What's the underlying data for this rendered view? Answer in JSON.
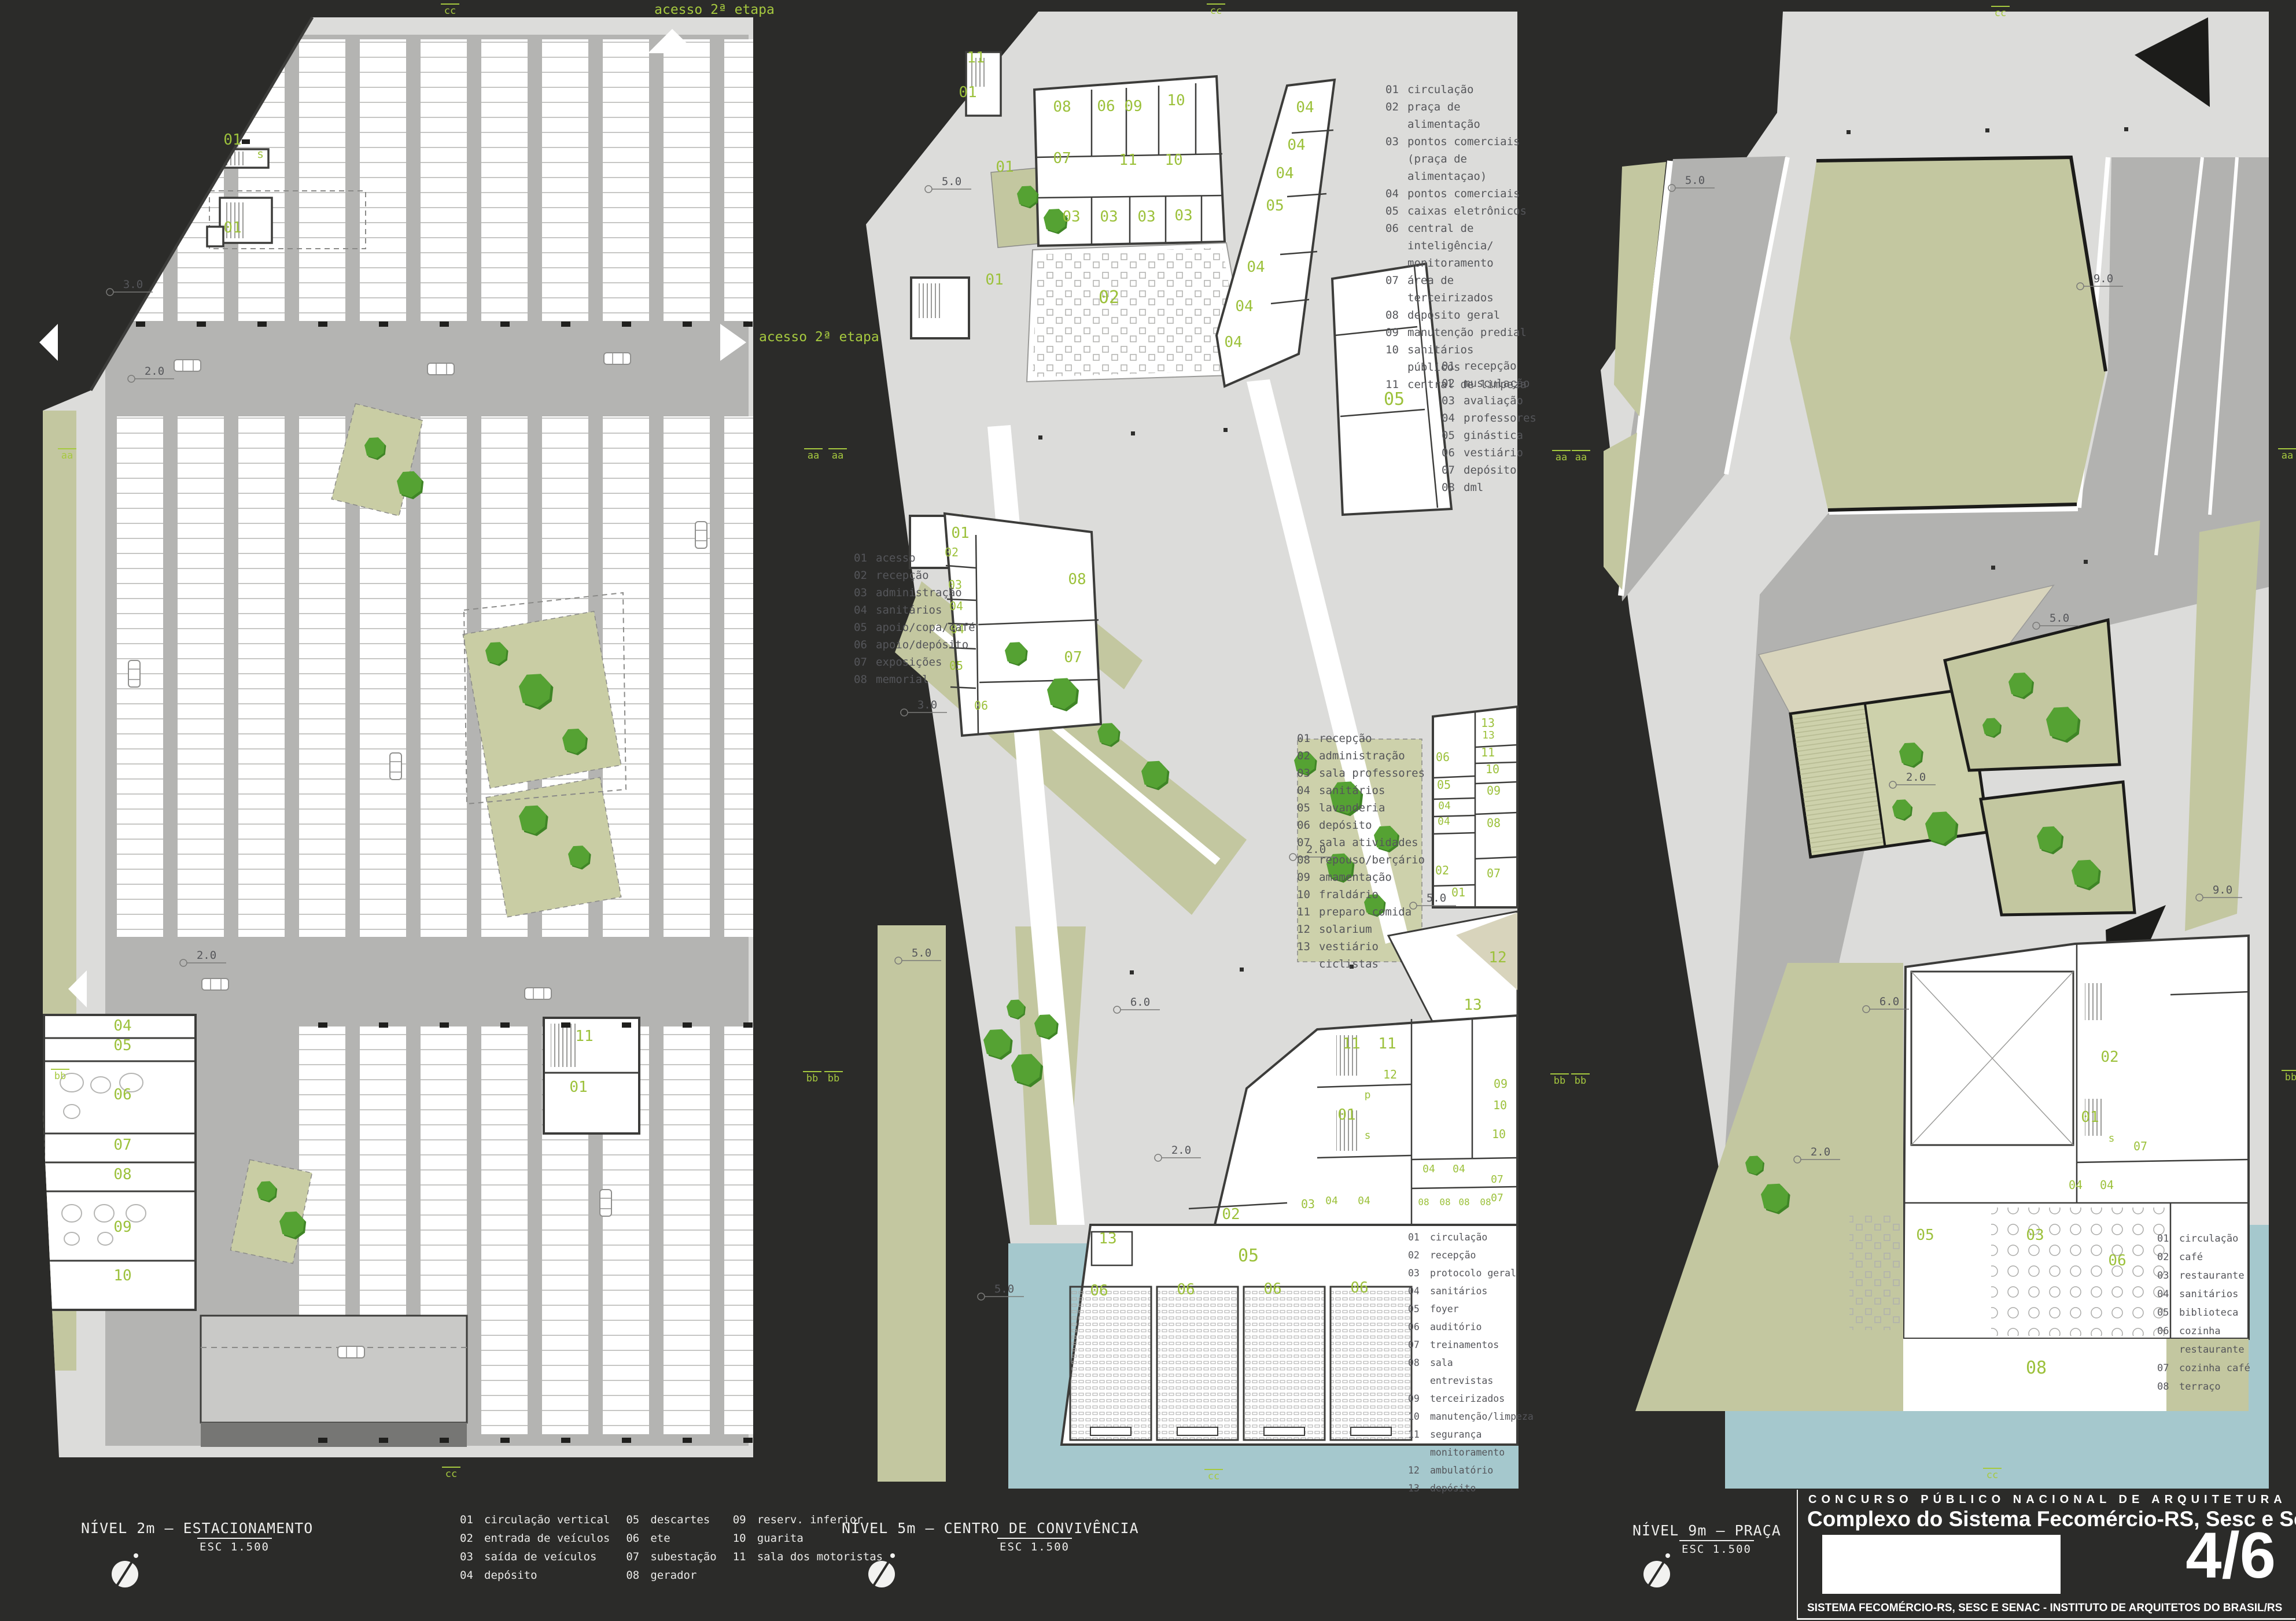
{
  "colors": {
    "background": "#2b2b29",
    "plan": "#dcdcda",
    "road": "#b2b2b0",
    "vegetation": "#c3c7a0",
    "vegetation_light": "#cdd1ab",
    "water": "#a5c8cd",
    "tree": "#55a233",
    "beige": "#d8d4bc",
    "label_green": "#9cc13b",
    "wall": "#3c3c3a"
  },
  "access_labels": {
    "top": "acesso 2ª etapa",
    "right": "acesso 2ª etapa"
  },
  "panels": {
    "parking": {
      "title": "NÍVEL 2m – ESTACIONAMENTO",
      "scale_label": "ESC 1.500",
      "legend_columns": [
        [
          {
            "n": "01",
            "l": "circulação vertical"
          },
          {
            "n": "02",
            "l": "entrada de veículos"
          },
          {
            "n": "03",
            "l": "saída de veículos"
          },
          {
            "n": "04",
            "l": "depósito"
          }
        ],
        [
          {
            "n": "05",
            "l": "descartes"
          },
          {
            "n": "06",
            "l": "ete"
          },
          {
            "n": "07",
            "l": "subestação"
          },
          {
            "n": "08",
            "l": "gerador"
          }
        ],
        [
          {
            "n": "09",
            "l": "reserv. inferior"
          },
          {
            "n": "10",
            "l": "guarita"
          },
          {
            "n": "11",
            "l": "sala dos motoristas"
          }
        ]
      ],
      "labels": [
        [
          "01",
          340,
          230
        ],
        [
          "s",
          388,
          253,
          20
        ],
        [
          "01",
          340,
          382
        ],
        [
          "04",
          150,
          1762
        ],
        [
          "05",
          150,
          1796
        ],
        [
          "06",
          150,
          1881
        ],
        [
          "07",
          150,
          1968
        ],
        [
          "08",
          150,
          2019
        ],
        [
          "09",
          150,
          2110
        ],
        [
          "10",
          150,
          2194
        ],
        [
          "11",
          948,
          1780
        ],
        [
          "01",
          938,
          1868
        ]
      ],
      "markers": [
        [
          "3.0",
          128,
          478
        ],
        [
          "2.0",
          165,
          628
        ],
        [
          "2.0",
          255,
          1638
        ]
      ]
    },
    "convivencia": {
      "title": "NÍVEL 5m – CENTRO DE CONVIVÊNCIA",
      "scale_label": "ESC 1.500",
      "legend_food": {
        "items": [
          {
            "n": "01",
            "l": "circulação"
          },
          {
            "n": "02",
            "l": "praça de alimentação"
          },
          {
            "n": "03",
            "l": "pontos comerciais\n(praça de alimentaçao)"
          },
          {
            "n": "04",
            "l": "pontos comerciais"
          },
          {
            "n": "05",
            "l": "caixas eletrônicos"
          },
          {
            "n": "06",
            "l": "central de inteligência/\nmonitoramento"
          },
          {
            "n": "07",
            "l": "área de terceirizados"
          },
          {
            "n": "08",
            "l": "depósito geral"
          },
          {
            "n": "09",
            "l": "manutenção predial"
          },
          {
            "n": "10",
            "l": "sanitários públicos"
          },
          {
            "n": "11",
            "l": "central de limpeza"
          }
        ]
      },
      "legend_gym": {
        "items": [
          {
            "n": "01",
            "l": "recepção"
          },
          {
            "n": "02",
            "l": "musculação"
          },
          {
            "n": "03",
            "l": "avaliação"
          },
          {
            "n": "04",
            "l": "professores"
          },
          {
            "n": "05",
            "l": "ginástica"
          },
          {
            "n": "06",
            "l": "vestiário"
          },
          {
            "n": "07",
            "l": "depósito"
          },
          {
            "n": "08",
            "l": "dml"
          }
        ]
      },
      "legend_memorial": {
        "items": [
          {
            "n": "01",
            "l": "acesso"
          },
          {
            "n": "02",
            "l": "recepção"
          },
          {
            "n": "03",
            "l": "administração"
          },
          {
            "n": "04",
            "l": "sanitários"
          },
          {
            "n": "05",
            "l": "apoio/copa/café"
          },
          {
            "n": "06",
            "l": "apoio/depósito"
          },
          {
            "n": "07",
            "l": "exposições"
          },
          {
            "n": "08",
            "l": "memorial"
          }
        ]
      },
      "legend_creche": {
        "items": [
          {
            "n": "01",
            "l": "recepção"
          },
          {
            "n": "02",
            "l": "administração"
          },
          {
            "n": "03",
            "l": "sala professores"
          },
          {
            "n": "04",
            "l": "sanitários"
          },
          {
            "n": "05",
            "l": "lavanderia"
          },
          {
            "n": "06",
            "l": "depósito"
          },
          {
            "n": "07",
            "l": "sala atividades"
          },
          {
            "n": "08",
            "l": "repouso/berçário"
          },
          {
            "n": "09",
            "l": "amamentação"
          },
          {
            "n": "10",
            "l": "fraldário"
          },
          {
            "n": "11",
            "l": "preparo comida"
          },
          {
            "n": "12",
            "l": "solarium"
          },
          {
            "n": "13",
            "l": "vestiário ciclistas"
          }
        ]
      },
      "legend_senac": {
        "items": [
          {
            "n": "01",
            "l": "circulação"
          },
          {
            "n": "02",
            "l": "recepção"
          },
          {
            "n": "03",
            "l": "protocolo geral"
          },
          {
            "n": "04",
            "l": "sanitários"
          },
          {
            "n": "05",
            "l": "foyer"
          },
          {
            "n": "06",
            "l": "auditório"
          },
          {
            "n": "07",
            "l": "treinamentos"
          },
          {
            "n": "08",
            "l": "sala entrevistas"
          },
          {
            "n": "09",
            "l": "terceirizados"
          },
          {
            "n": "10",
            "l": "manutenção/limpeza"
          },
          {
            "n": "11",
            "l": "segurança\nmonitoramento"
          },
          {
            "n": "12",
            "l": "ambulatório"
          },
          {
            "n": "13",
            "l": "depósito"
          }
        ]
      },
      "labels": [
        [
          "11",
          232,
          88
        ],
        [
          "01",
          218,
          148
        ],
        [
          "08",
          381,
          173
        ],
        [
          "06",
          457,
          172
        ],
        [
          "09",
          504,
          172
        ],
        [
          "10",
          578,
          162
        ],
        [
          "07",
          381,
          262
        ],
        [
          "11",
          495,
          265
        ],
        [
          "10",
          574,
          265
        ],
        [
          "03",
          397,
          363
        ],
        [
          "03",
          462,
          363
        ],
        [
          "03",
          527,
          363
        ],
        [
          "03",
          591,
          361
        ],
        [
          "04",
          801,
          174
        ],
        [
          "04",
          786,
          239
        ],
        [
          "04",
          766,
          288
        ],
        [
          "05",
          749,
          344
        ],
        [
          "04",
          716,
          450
        ],
        [
          "04",
          696,
          518
        ],
        [
          "04",
          677,
          580
        ],
        [
          "01",
          282,
          277
        ],
        [
          "01",
          264,
          472
        ],
        [
          "02",
          462,
          504,
          30
        ],
        [
          "05",
          955,
          680,
          30
        ],
        [
          "01",
          205,
          910
        ],
        [
          "02",
          190,
          942,
          20
        ],
        [
          "03",
          196,
          998,
          20
        ],
        [
          "04",
          198,
          1035,
          20
        ],
        [
          "04",
          200,
          1075,
          20
        ],
        [
          "05",
          198,
          1138,
          20
        ],
        [
          "06",
          241,
          1207,
          20
        ],
        [
          "08",
          407,
          990
        ],
        [
          "07",
          400,
          1125
        ],
        [
          "06",
          1039,
          1296,
          20
        ],
        [
          "05",
          1041,
          1344,
          20
        ],
        [
          "04",
          1042,
          1379,
          18
        ],
        [
          "04",
          1041,
          1406,
          18
        ],
        [
          "02",
          1038,
          1492,
          20
        ],
        [
          "01",
          1066,
          1530,
          20
        ],
        [
          "13",
          1117,
          1237,
          20
        ],
        [
          "13",
          1118,
          1257,
          18
        ],
        [
          "11",
          1117,
          1288,
          20
        ],
        [
          "10",
          1125,
          1317,
          20
        ],
        [
          "09",
          1127,
          1354,
          20
        ],
        [
          "08",
          1127,
          1410,
          20
        ],
        [
          "07",
          1127,
          1497,
          20
        ],
        [
          "12",
          1134,
          1644
        ],
        [
          "13",
          1091,
          1726
        ],
        [
          "11",
          881,
          1793
        ],
        [
          "11",
          943,
          1793
        ],
        [
          "12",
          948,
          1845,
          20
        ],
        [
          "01",
          873,
          1916
        ],
        [
          "p",
          909,
          1879,
          18
        ],
        [
          "s",
          909,
          1949,
          18
        ],
        [
          "09",
          1139,
          1861,
          20
        ],
        [
          "10",
          1138,
          1898,
          20
        ],
        [
          "10",
          1136,
          1948,
          20
        ],
        [
          "02",
          673,
          2088
        ],
        [
          "03",
          806,
          2069,
          20
        ],
        [
          "04",
          847,
          2062,
          18
        ],
        [
          "04",
          903,
          2062,
          18
        ],
        [
          "13",
          460,
          2130
        ],
        [
          "05",
          703,
          2161,
          30
        ],
        [
          "06",
          445,
          2220
        ],
        [
          "06",
          595,
          2218
        ],
        [
          "06",
          745,
          2217
        ],
        [
          "06",
          895,
          2215
        ],
        [
          "04",
          1015,
          2007,
          18
        ],
        [
          "04",
          1067,
          2007,
          18
        ],
        [
          "08",
          1006,
          2064,
          16
        ],
        [
          "08",
          1043,
          2064,
          16
        ],
        [
          "08",
          1076,
          2064,
          16
        ],
        [
          "08",
          1113,
          2064,
          16
        ],
        [
          "07",
          1133,
          2025,
          18
        ],
        [
          "07",
          1133,
          2057,
          18
        ]
      ],
      "markers": [
        [
          "5.0",
          150,
          300
        ],
        [
          "3.0",
          108,
          1205
        ],
        [
          "2.0",
          780,
          1455
        ],
        [
          "5.0",
          988,
          1539
        ],
        [
          "5.0",
          98,
          1634
        ],
        [
          "6.0",
          476,
          1719
        ],
        [
          "2.0",
          547,
          1975
        ],
        [
          "5.0",
          241,
          2215
        ]
      ]
    },
    "praca": {
      "title": "NÍVEL 9m – PRAÇA",
      "scale_label": "ESC 1.500",
      "legend_cafe": {
        "items": [
          {
            "n": "01",
            "l": "circulação"
          },
          {
            "n": "02",
            "l": "café"
          },
          {
            "n": "03",
            "l": "restaurante"
          },
          {
            "n": "04",
            "l": "sanitários"
          },
          {
            "n": "05",
            "l": "biblioteca"
          },
          {
            "n": "06",
            "l": "cozinha\nrestaurante"
          },
          {
            "n": "07",
            "l": "cozinha café"
          },
          {
            "n": "08",
            "l": "terraço"
          }
        ]
      },
      "labels": [
        [
          "01",
          871,
          1920
        ],
        [
          "02",
          905,
          1816
        ],
        [
          "07",
          958,
          1969,
          20
        ],
        [
          "s",
          908,
          1954,
          18
        ],
        [
          "04",
          846,
          2036,
          20
        ],
        [
          "04",
          900,
          2036,
          20
        ],
        [
          "05",
          586,
          2124
        ],
        [
          "03",
          776,
          2124
        ],
        [
          "06",
          918,
          2168
        ],
        [
          "08",
          778,
          2355,
          30
        ]
      ],
      "markers": [
        [
          "5.0",
          148,
          298
        ],
        [
          "9.0",
          854,
          468
        ],
        [
          "9.0",
          1060,
          1525
        ],
        [
          "2.0",
          530,
          1330
        ],
        [
          "5.0",
          778,
          1055
        ],
        [
          "6.0",
          484,
          1718
        ],
        [
          "2.0",
          365,
          1978
        ]
      ]
    }
  },
  "section_markers": [
    [
      "aa",
      100,
      775
    ],
    [
      "aa",
      1390,
      775
    ],
    [
      "aa",
      1432,
      775
    ],
    [
      "aa",
      2683,
      778
    ],
    [
      "aa",
      2717,
      778
    ],
    [
      "aa",
      3938,
      775
    ],
    [
      "bb",
      88,
      1848
    ],
    [
      "bb",
      1388,
      1852
    ],
    [
      "bb",
      1425,
      1852
    ],
    [
      "bb",
      2680,
      1856
    ],
    [
      "bb",
      2716,
      1856
    ],
    [
      "bb",
      3944,
      1850
    ],
    [
      "cc",
      762,
      6
    ],
    [
      "cc",
      2086,
      6
    ],
    [
      "cc",
      3442,
      10
    ],
    [
      "cc",
      764,
      2536
    ],
    [
      "cc",
      2082,
      2540
    ],
    [
      "cc",
      3428,
      2538
    ]
  ],
  "titleblock": {
    "line1": "CONCURSO PÚBLICO NACIONAL DE ARQUITETURA",
    "line2": "Complexo do Sistema Fecomércio-RS, Sesc e Senac",
    "sheet": "4/6",
    "footer": "SISTEMA FECOMÉRCIO-RS, SESC E SENAC - INSTITUTO DE ARQUITETOS DO BRASIL/RS"
  }
}
